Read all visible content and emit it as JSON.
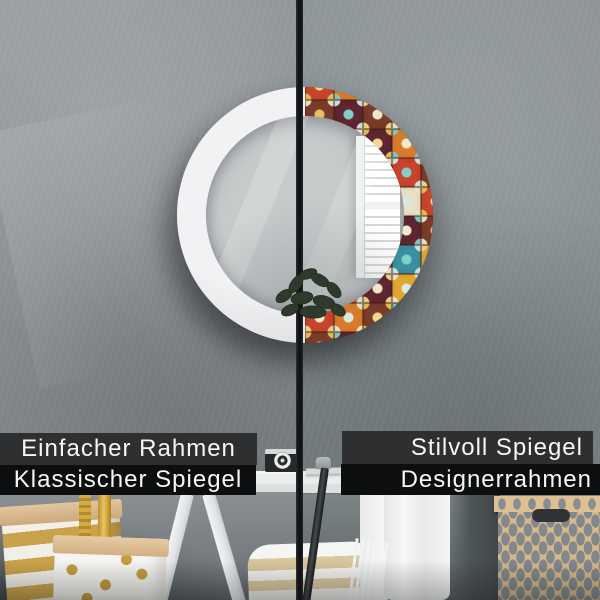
{
  "product_labels": {
    "left_panel": {
      "line1": "Einfacher Rahmen",
      "line2": "Klassischer Spiegel"
    },
    "right_panel": {
      "line1": "Stilvoll Spiegel",
      "line2": "Designerrahmen"
    }
  },
  "colors": {
    "wall_left": "#878d8f",
    "wall_right": "#7e8587",
    "divider": "#121416",
    "bar_top": "#2e2f31",
    "bar_bottom": "#0d0e10",
    "label_text": "#f6f6f6",
    "frame_white": "#e9e9eb",
    "glass": "#c7cacb",
    "window_white": "#fafbfb",
    "gold": "#c9a24b",
    "kraft": "#d9bc94",
    "box_tan": "#d7b88a",
    "box_pattern": "#82888b",
    "plant_green": "#2e3a2c"
  },
  "tiles": {
    "palette": [
      "#2fa69a",
      "#5f2531",
      "#d97b2b",
      "#e0a72e",
      "#e9dfc4",
      "#7a3b2a",
      "#3a8fa0",
      "#c8442c"
    ],
    "motifs": [
      "#f3ead0",
      "#e8c25a",
      "#7fd0c6",
      "#f0e6c8",
      "#d8e8e4",
      "#f2d98c"
    ]
  }
}
